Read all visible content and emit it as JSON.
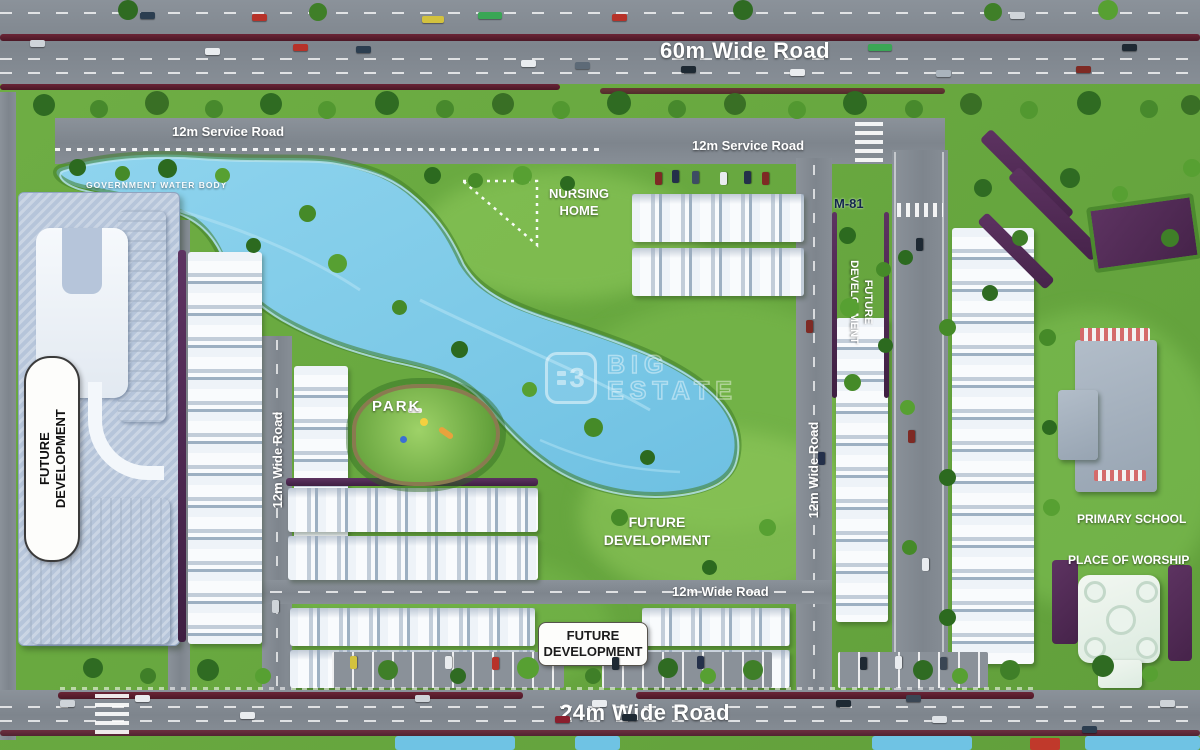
{
  "plan": {
    "watermark": {
      "logo_glyph": "3",
      "line1": "BIG",
      "line2": "ESTATE"
    },
    "roads": {
      "top_label": "60m Wide Road",
      "service_left_label": "12m Service Road",
      "service_right_label": "12m Service Road",
      "left_vertical_label": "12m Wide Road",
      "right_vertical_label": "12m Wide Road",
      "center_horizontal_label": "12m Wide Road",
      "bottom_label": "24m Wide Road"
    },
    "areas": {
      "water_body_label": "GOVERNMENT WATER BODY",
      "nursing_home_line1": "NURSING",
      "nursing_home_line2": "HOME",
      "park_label": "PARK",
      "plot_marker": "M-81",
      "future_dev_tower_line1": "FUTURE",
      "future_dev_tower_line2": "DEVELOPMENT",
      "future_dev_strip_line1": "FUTURE",
      "future_dev_strip_line2": "DEVELOPMENT",
      "future_dev_center_line1": "FUTURE",
      "future_dev_center_line2": "DEVELOPMENT",
      "future_dev_south_line1": "FUTURE",
      "future_dev_south_line2": "DEVELOPMENT",
      "primary_school_label": "PRIMARY SCHOOL",
      "place_of_worship_label": "PLACE OF WORSHIP"
    },
    "colors": {
      "grass": "#6cab45",
      "water": "#7fcbe8",
      "road": "#868d95",
      "hedge": "#53274f",
      "median": "#5c1f2e",
      "building": "#f3f7fb"
    }
  }
}
